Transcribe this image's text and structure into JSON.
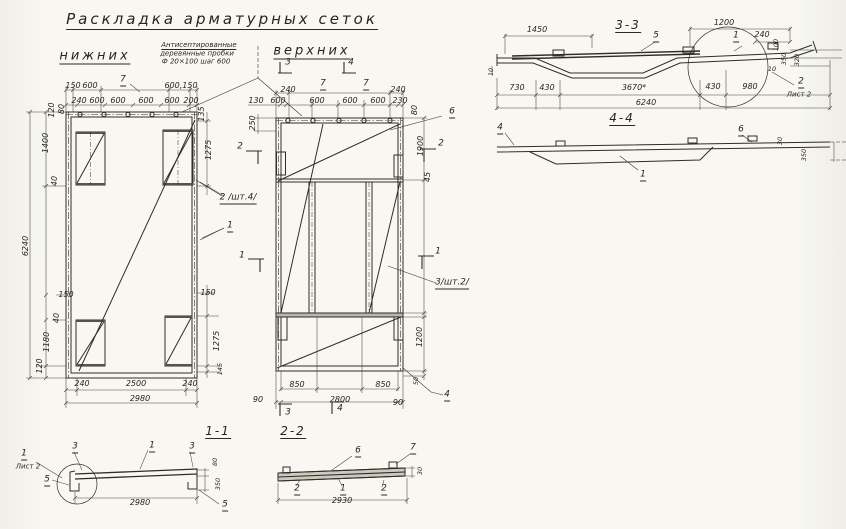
{
  "title": "Раскладка арматурных сеток",
  "lower_view": {
    "subtitle": "нижних",
    "note": {
      "line1": "Антисептированные",
      "line2": "деревянные пробки",
      "line3": "Ф 20×100 шаг 600"
    },
    "ref_plugs": "7",
    "ref_mesh2": "2 /шт.4/",
    "ref_mesh1": "1",
    "dims": {
      "top1_a": "150",
      "top1_b": "600",
      "top1_c": "600,150",
      "top2": [
        "240",
        "600",
        "600",
        "600",
        "600",
        "200"
      ],
      "left": [
        "120",
        "80",
        "1400",
        "40",
        "6240",
        "150",
        "40",
        "1180",
        "120"
      ],
      "right": [
        "135",
        "1275",
        "150",
        "1275",
        "145"
      ],
      "bottom": [
        "240",
        "2500",
        "240",
        "2980"
      ]
    }
  },
  "upper_view": {
    "subtitle": "верхних",
    "ref_plugs_a": "7",
    "ref_plugs_b": "7",
    "ref_mesh6": "6",
    "ref_mesh3": "3/шт.2/",
    "ref_mesh4": "4",
    "dims": {
      "top1_a": "240",
      "top1_b": "240",
      "top2": [
        "130",
        "600",
        "600",
        "600",
        "600",
        "230"
      ],
      "left": [
        "250"
      ],
      "right": [
        "80",
        "1900",
        "45",
        "1200",
        "50"
      ],
      "bottom": [
        "850",
        "850",
        "90",
        "2800",
        "90"
      ]
    }
  },
  "marks": {
    "m1": "1",
    "m2": "2",
    "m3": "3",
    "m4": "4"
  },
  "section_3_3": {
    "title": "3-3",
    "ref5": "5",
    "ref1": "1",
    "ref2": "2",
    "sheet2": "Лист 2",
    "dims": {
      "top_a": "1450",
      "top_b": "1200",
      "top_c": "240",
      "left": "10",
      "right": [
        "100",
        "350",
        "10",
        "320"
      ],
      "bottom": [
        "730",
        "430",
        "3670*",
        "430",
        "980",
        "6240"
      ]
    }
  },
  "section_4_4": {
    "title": "4-4",
    "ref4": "4",
    "ref6": "6",
    "ref1": "1",
    "dims": {
      "right": [
        "30",
        "350"
      ]
    }
  },
  "section_1_1": {
    "title": "1-1",
    "ref3a": "3",
    "ref1": "1",
    "ref3b": "3",
    "ref5a": "5",
    "ref5b": "5",
    "detail_ref": "1",
    "detail_sheet": "Лист 2",
    "dims": {
      "right": [
        "80",
        "350"
      ],
      "bottom": "2980"
    }
  },
  "section_2_2": {
    "title": "2-2",
    "ref6": "6",
    "ref7": "7",
    "ref2a": "2",
    "ref1": "1",
    "ref2b": "2",
    "dims": {
      "right": "30",
      "bottom": "2930"
    }
  }
}
